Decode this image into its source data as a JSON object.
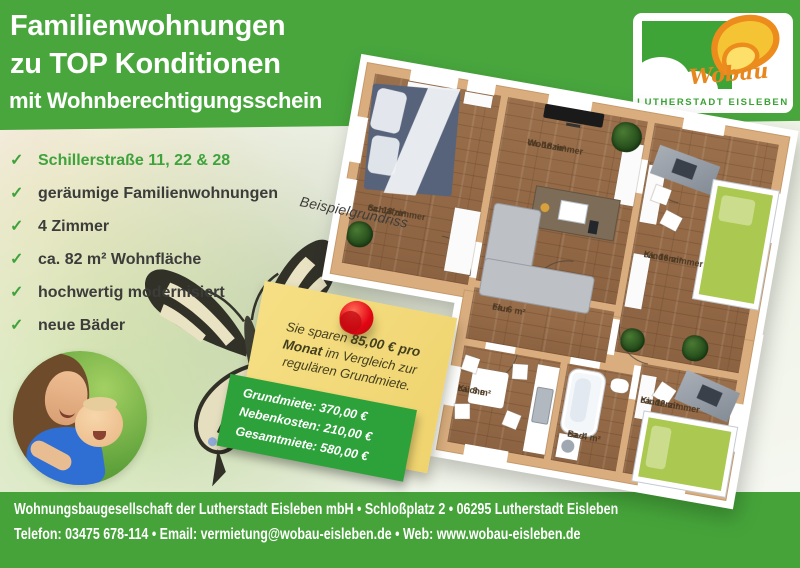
{
  "banner": {
    "title_line1": "Familienwohnungen",
    "title_line2": "zu TOP Konditionen",
    "title_line3": "mit Wohnberechtigungsschein"
  },
  "logo": {
    "brand": "Wobau",
    "city": "LUTHERSTADT EISLEBEN"
  },
  "features": {
    "items": [
      {
        "label": "Schillerstraße 11, 22 & 28"
      },
      {
        "label": "geräumige Familienwohnungen"
      },
      {
        "label": "4 Zimmer"
      },
      {
        "label": "ca. 82 m² Wohnfläche"
      },
      {
        "label": "hochwertig modernisiert"
      },
      {
        "label": "neue Bäder"
      }
    ]
  },
  "floorplan": {
    "caption": "Beispielgrundriss",
    "rooms": [
      {
        "name": "Schlafzimmer",
        "area": "ca. 18 m²"
      },
      {
        "name": "Wohnzimmer",
        "area": "ca. 18 m²"
      },
      {
        "name": "Kinderzimmer",
        "area": "ca. 16 m²"
      },
      {
        "name": "Flur",
        "area": "ca. 6 m²"
      },
      {
        "name": "Küche",
        "area": "ca. 8 m²"
      },
      {
        "name": "Bad",
        "area": "ca. 4 m²"
      },
      {
        "name": "Kinderzimmer",
        "area": "ca. 12 m²"
      }
    ]
  },
  "note": {
    "text_prefix": "Sie sparen ",
    "text_bold": "85,00 € pro Monat",
    "text_suffix": " im Vergleich zur regulären Grundmiete.",
    "prices": [
      {
        "label": "Grundmiete:",
        "value": "370,00 €"
      },
      {
        "label": "Nebenkosten:",
        "value": "210,00 €"
      },
      {
        "label": "Gesamtmiete:",
        "value": "580,00 €"
      }
    ]
  },
  "footer": {
    "line1": "Wohnungsbaugesellschaft der Lutherstadt Eisleben mbH • Schloßplatz 2 • 06295 Lutherstadt Eisleben",
    "line2": "Telefon: 03475 678-114 • Email: vermietung@wobau-eisleben.de • Web: www.wobau-eisleben.de"
  },
  "icons": {
    "check": "✓"
  },
  "colors": {
    "brand_green": "#48a63d",
    "price_box_green": "#2ea23a",
    "note_yellow": "#f3d976",
    "pin_red": "#e30613",
    "logo_orange": "#e8871d"
  }
}
